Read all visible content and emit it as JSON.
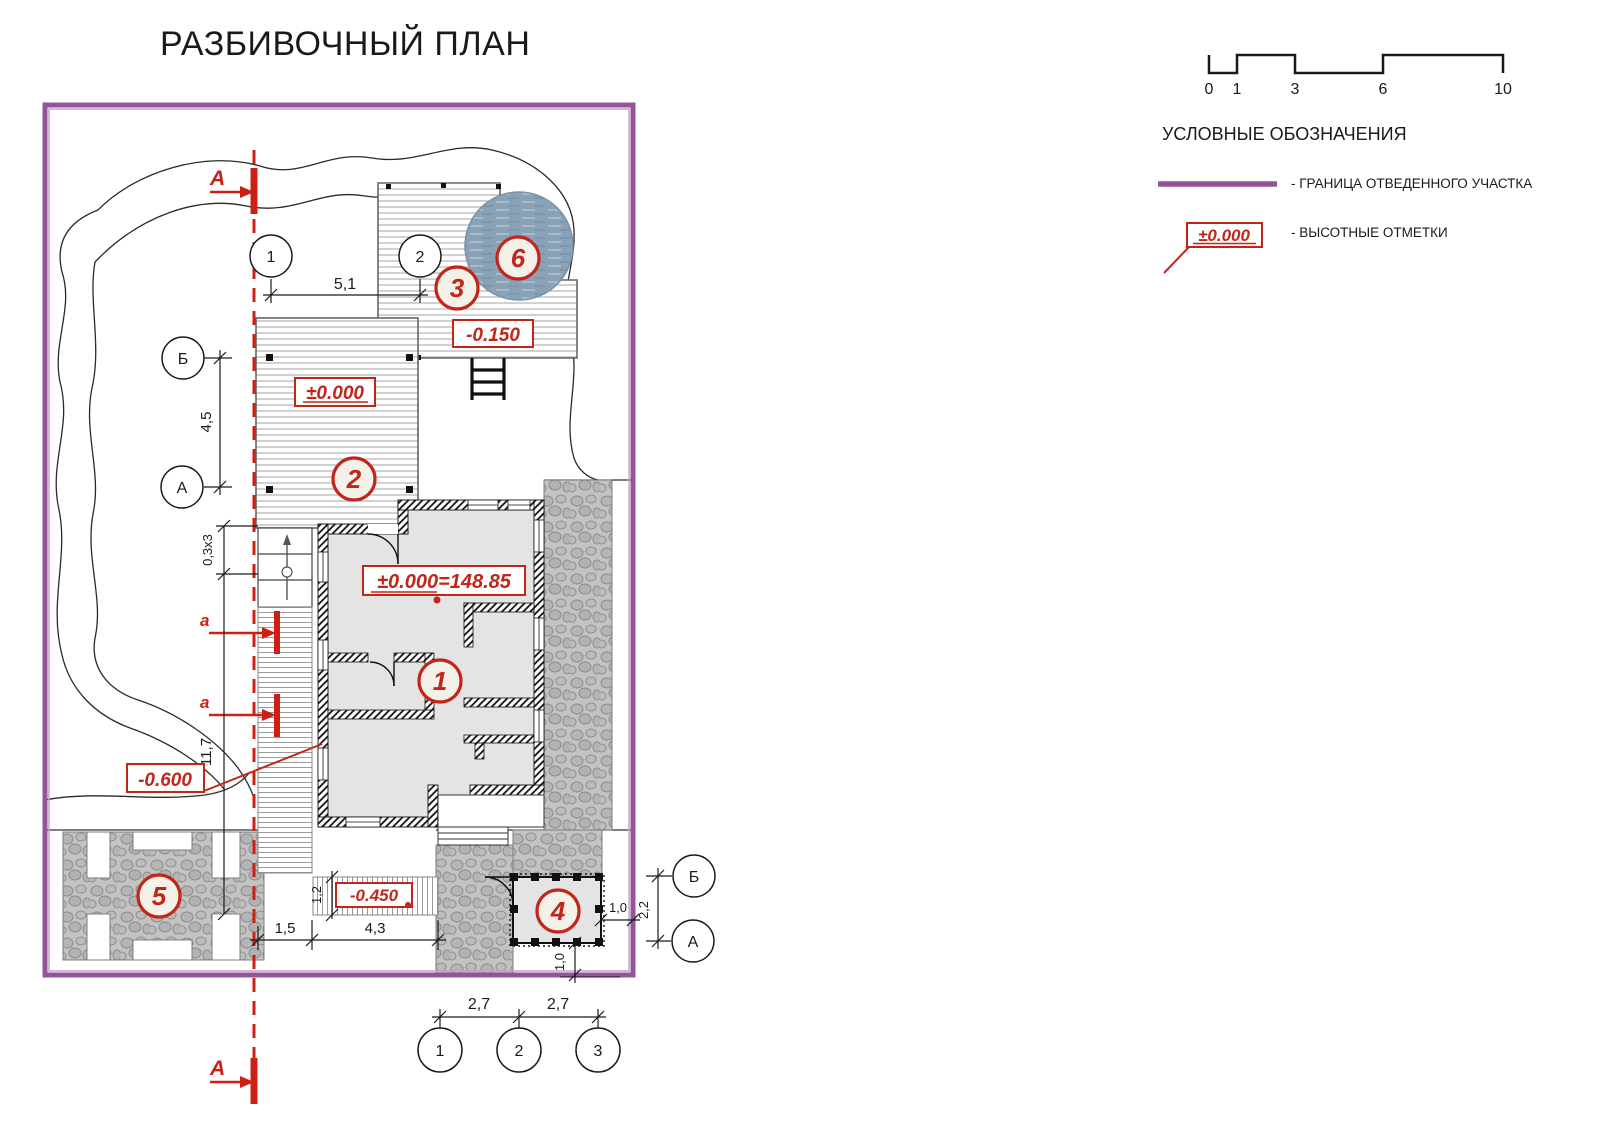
{
  "title": "РАЗБИВОЧНЫЙ ПЛАН",
  "scale_bar": {
    "ticks": {
      "t0": "0",
      "t1": "1",
      "t3": "3",
      "t6": "6",
      "t10": "10"
    }
  },
  "legend": {
    "title": "УСЛОВНЫЕ ОБОЗНАЧЕНИЯ",
    "boundary_item_label": "- ГРАНИЦА ОТВЕДЕННОГО УЧАСТКА",
    "elevation_item_sample": "±0.000",
    "elevation_item_label": "- ВЫСОТНЫЕ ОТМЕТКИ"
  },
  "plan": {
    "section_label_main": "А",
    "section_label_local": "а",
    "axes": {
      "top_1": "1",
      "top_2": "2",
      "left_b": "Б",
      "left_a": "А",
      "right_b": "Б",
      "right_a": "А",
      "bottom_1": "1",
      "bottom_2": "2",
      "bottom_3": "3"
    },
    "markers": {
      "house": "1",
      "deck": "2",
      "upper_deck": "3",
      "outbuilding": "4",
      "parking": "5",
      "pool": "6"
    },
    "elevations": {
      "deck": "±0.000",
      "upper_deck": "-0.150",
      "house": "±0.000=148.85",
      "path": "-0.450",
      "ground": "-0.600"
    },
    "dims": {
      "top": "5,1",
      "left": "4,5",
      "steps": "0,3x3",
      "walkway": "11,7",
      "walk_offset": "1,5",
      "path_len": "4,3",
      "path_w": "1,2",
      "bottom_12": "2,7",
      "bottom_23": "2,7",
      "outb_right": "1,0",
      "outb_bottom": "1,0",
      "axis_right": "2,2"
    }
  },
  "colors": {
    "boundary_purple": "#93549a",
    "annotation_red": "#c2261b",
    "section_red": "#cc2015",
    "pool_blue": "#8aa2b8",
    "stone_gray": "#c3c3c3"
  }
}
